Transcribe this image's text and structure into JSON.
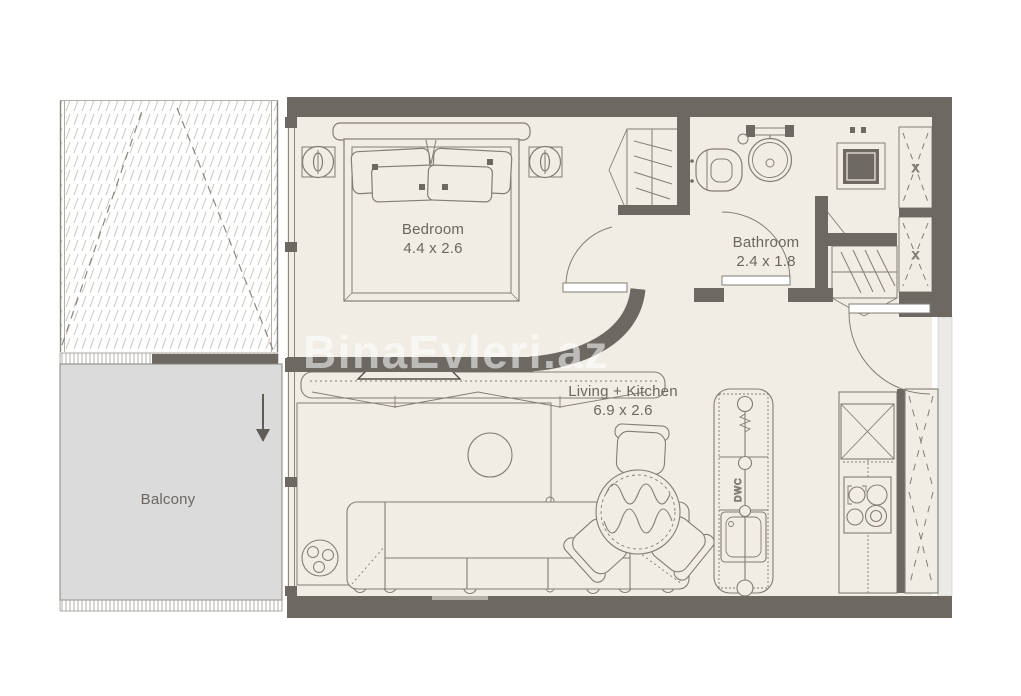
{
  "watermark": "BinaEvleri.az",
  "rooms": {
    "bedroom": {
      "name": "Bedroom",
      "dimensions": "4.4 x 2.6"
    },
    "bathroom": {
      "name": "Bathroom",
      "dimensions": "2.4 x 1.8"
    },
    "living_kitchen": {
      "name": "Living + Kitchen",
      "dimensions": "6.9 x 2.6"
    },
    "balcony": {
      "name": "Balcony"
    }
  },
  "annotations": {
    "dishwasher_label": "DWC",
    "closet_mark": "X"
  },
  "colors": {
    "wall": "#6e6862",
    "floor": "#f2ede4",
    "balcony_fill": "#dbdbdb",
    "outline": "#827d75",
    "text": "#6b6661",
    "watermark": "rgba(255,255,255,0.55)"
  }
}
